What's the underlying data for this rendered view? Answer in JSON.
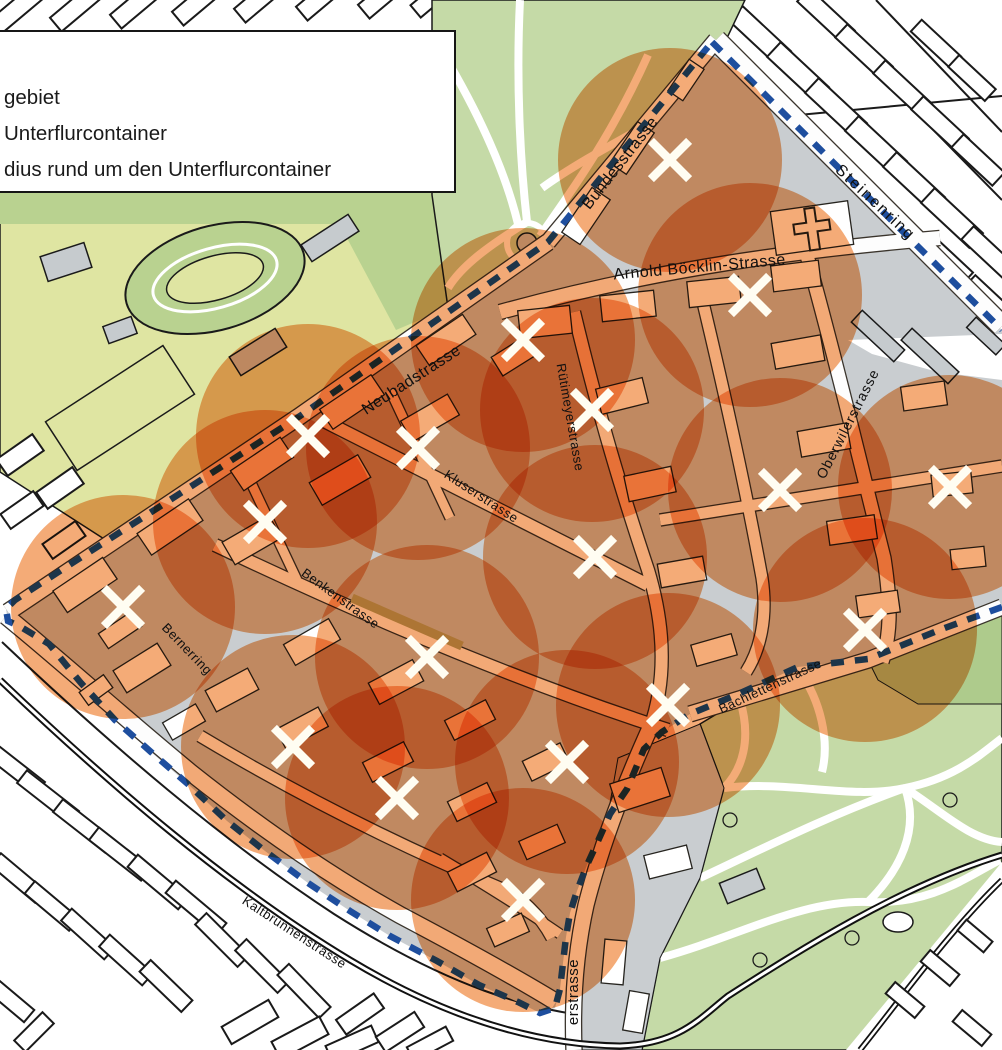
{
  "legend": {
    "items": [
      {
        "label": "gebiet"
      },
      {
        "label": "Unterflurcontainer"
      },
      {
        "label": "dius rund um den Unterflurcontainer"
      }
    ]
  },
  "map": {
    "street_labels": [
      {
        "text": "Bundesstrasse",
        "x": 624,
        "y": 166,
        "rot": -52,
        "size": 16,
        "ls": 0.5
      },
      {
        "text": "Steinenring",
        "x": 872,
        "y": 206,
        "rot": 43,
        "size": 16,
        "ls": 2
      },
      {
        "text": "Arnold Böcklin-Strasse",
        "x": 700,
        "y": 272,
        "rot": -5,
        "size": 16,
        "ls": 0.5
      },
      {
        "text": "Neubadstrasse",
        "x": 414,
        "y": 384,
        "rot": -33,
        "size": 16,
        "ls": 0.5
      },
      {
        "text": "Rütimeyerstrasse",
        "x": 566,
        "y": 418,
        "rot": 80,
        "size": 13,
        "ls": 0.5
      },
      {
        "text": "Kluserstrasse",
        "x": 479,
        "y": 500,
        "rot": 33,
        "size": 13,
        "ls": 0.5
      },
      {
        "text": "Benkenstrasse",
        "x": 338,
        "y": 602,
        "rot": 36,
        "size": 13,
        "ls": 0.5
      },
      {
        "text": "Bernerring",
        "x": 184,
        "y": 652,
        "rot": 46,
        "size": 13,
        "ls": 0.5
      },
      {
        "text": "Oberwilerstrasse",
        "x": 852,
        "y": 426,
        "rot": -63,
        "size": 14,
        "ls": 1
      },
      {
        "text": "Bachlettenstrasse",
        "x": 772,
        "y": 690,
        "rot": -25,
        "size": 13,
        "ls": 0.5
      },
      {
        "text": "Kaltbrunnenstrasse",
        "x": 292,
        "y": 936,
        "rot": 33,
        "size": 13,
        "ls": 0.5
      },
      {
        "text": "erstrasse",
        "x": 578,
        "y": 992,
        "rot": -90,
        "size": 15,
        "ls": 0.5
      }
    ],
    "containers": {
      "symbol": "x-cross-marker",
      "color": "#FFFDF2",
      "positions": [
        [
          670,
          160
        ],
        [
          750,
          295
        ],
        [
          523,
          340
        ],
        [
          592,
          410
        ],
        [
          308,
          436
        ],
        [
          418,
          448
        ],
        [
          265,
          522
        ],
        [
          123,
          607
        ],
        [
          595,
          557
        ],
        [
          427,
          657
        ],
        [
          293,
          747
        ],
        [
          397,
          798
        ],
        [
          523,
          900
        ],
        [
          567,
          762
        ],
        [
          668,
          705
        ],
        [
          780,
          490
        ],
        [
          950,
          487
        ],
        [
          865,
          630
        ]
      ]
    },
    "radius_circles": {
      "radius": 112,
      "fill": "#F29C5F",
      "opacity": 0.85
    },
    "boundary": {
      "color": "#1E4E9E",
      "dash": "13 11",
      "width": 6.5,
      "path": "M 712,42 L 1002,330 M 1002,607 L 942,629 L 868,659 L 798,667 L 736,695 L 690,714 L 662,732 L 644,749 L 627,789 L 610,814 L 598,841 L 587,865 L 577,891 L 570,913 L 566,937 L 563,963 L 560,989 L 555,1008 L 540,1013 L 518,1002 L 479,985 L 437,961 L 390,936 L 350,911 L 308,883 L 265,851 L 227,821 L 189,785 L 151,752 L 115,720 L 81,683 L 49,644 L 21,627 L 8,621 L 6,609 L 15,600 L 300,416 L 548,242 L 712,42"
    },
    "colors": {
      "circle_orange": "#F29C5F",
      "boundary_blue": "#1E4E9E",
      "park_green": "#C5DAA7",
      "olive_green": "#AECB8C",
      "sports_field_yellow": "#DFE5A2",
      "sports_green": "#B9D290",
      "ground_gray": "#C9CDD0",
      "building_gray": "#C6CBCE",
      "building_white": "#FFFFFF",
      "line_dark": "#1A1A1A",
      "marker_white": "#FFFDF2"
    }
  }
}
